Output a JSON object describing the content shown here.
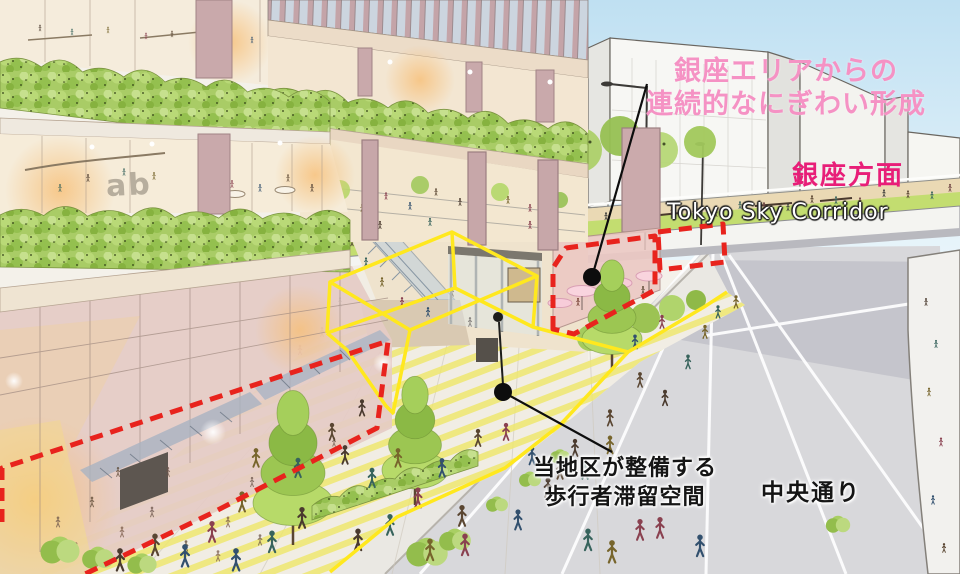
{
  "labels": {
    "ginza_continuity": {
      "line1": "銀座エリアからの",
      "line2": "連続的なにぎわい形成"
    },
    "ginza_direction": "銀座方面",
    "sky_corridor": "Tokyo Sky Corridor",
    "pedestrian_space": {
      "line1": "当地区が整備する",
      "line2": "歩行者滞留空間"
    },
    "street": "中央通り",
    "building_sign": "ab"
  },
  "colors": {
    "annotation-pink": "#F592C4",
    "direction-magenta": "#E81E78",
    "highlight-red": "#E8231D",
    "boundary-yellow": "#FFE81E",
    "note-black": "#151515",
    "corridor-white": "#FFFFFF",
    "sky-blue": "#C7E4F4"
  }
}
